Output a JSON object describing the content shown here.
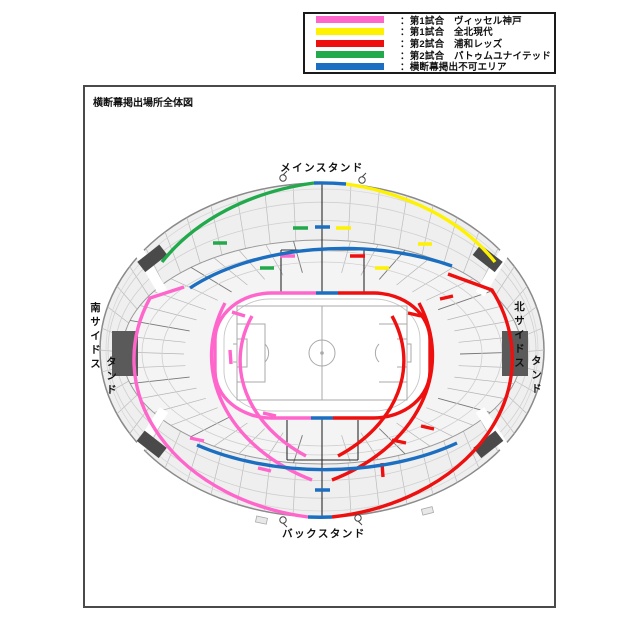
{
  "legend": {
    "items": [
      {
        "id": "match1-vissel",
        "color_key": "pink",
        "label": "：第1試合　ヴィッセル神戸"
      },
      {
        "id": "match1-jeonbuk",
        "color_key": "yellow",
        "label": "：第1試合　全北現代"
      },
      {
        "id": "match2-urawa",
        "color_key": "red",
        "label": "：第2試合　浦和レッズ"
      },
      {
        "id": "match2-pathum",
        "color_key": "green",
        "label": "：第2試合　パトゥムユナイテッド"
      },
      {
        "id": "no-banner-area",
        "color_key": "blue",
        "label": "：横断幕掲出不可エリア"
      }
    ]
  },
  "map": {
    "title": "横断幕掲出場所全体図",
    "stands": {
      "main": "メインスタンド",
      "back": "バックスタンド",
      "south1": "南サイドス",
      "south2": "タンド",
      "north1": "北サイドス",
      "north2": "タンド"
    }
  },
  "colors": {
    "pink": "#ff66cc",
    "yellow": "#fff200",
    "red": "#ee0f0f",
    "green": "#22a94c",
    "blue": "#1b6ec0"
  }
}
